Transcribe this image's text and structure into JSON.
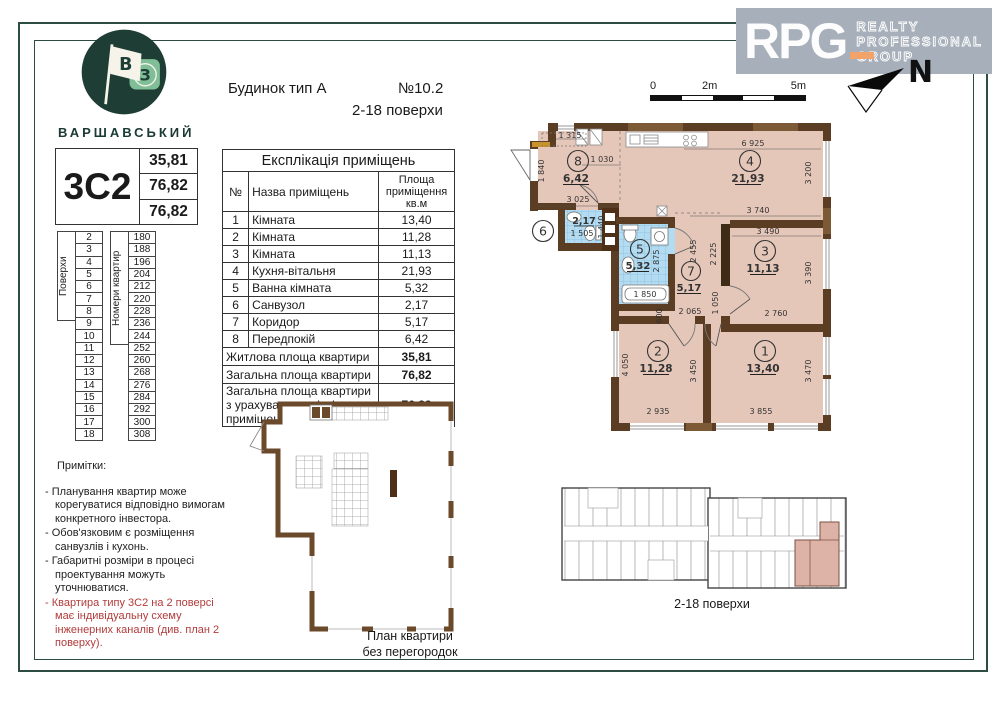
{
  "header": {
    "logo": {
      "brand": "ВАРШАВСЬКИЙ",
      "flag_letter_b": "В",
      "flag_letter_z": "З"
    },
    "building": "Будинок тип А",
    "plan_no": "№10.2",
    "floors_range": "2-18  поверхи",
    "rpg": {
      "acronym": "RPG",
      "lines": [
        "REALTY",
        "PROFESSIONAL",
        "GROUP"
      ],
      "north": "N"
    },
    "scalebar": {
      "l0": "0",
      "l2": "2m",
      "l5": "5m"
    }
  },
  "apartment": {
    "type": "3С2",
    "living_area": "35,81",
    "total_area": "76,82",
    "total_with_summer": "76,82"
  },
  "floors_table": {
    "col1_label": "Поверхи",
    "col2_label": "Номери квартир",
    "floors": [
      "2",
      "3",
      "4",
      "5",
      "6",
      "7",
      "8",
      "9",
      "10",
      "11",
      "12",
      "13",
      "14",
      "15",
      "16",
      "17",
      "18"
    ],
    "numbers": [
      "180",
      "188",
      "196",
      "204",
      "212",
      "220",
      "228",
      "236",
      "244",
      "252",
      "260",
      "268",
      "276",
      "284",
      "292",
      "300",
      "308"
    ]
  },
  "explication": {
    "title": "Експлікація приміщень",
    "col_no": "№",
    "col_name": "Назва приміщень",
    "col_area": "Площа приміщення кв.м",
    "rows": [
      {
        "no": "1",
        "name": "Кімната",
        "area": "13,40"
      },
      {
        "no": "2",
        "name": "Кімната",
        "area": "11,28"
      },
      {
        "no": "3",
        "name": "Кімната",
        "area": "11,13"
      },
      {
        "no": "4",
        "name": "Кухня-вітальня",
        "area": "21,93"
      },
      {
        "no": "5",
        "name": "Ванна кімната",
        "area": "5,32"
      },
      {
        "no": "6",
        "name": "Санвузол",
        "area": "2,17"
      },
      {
        "no": "7",
        "name": "Коридор",
        "area": "5,17"
      },
      {
        "no": "8",
        "name": "Передпокій",
        "area": "6,42"
      }
    ],
    "summary": [
      {
        "name": "Житлова площа квартири",
        "area": "35,81"
      },
      {
        "name": "Загальна площа квартири",
        "area": "76,82"
      },
      {
        "name": "Загальна площа квартири з урахуванням літніх приміщень",
        "area": "76,82"
      }
    ]
  },
  "notes": {
    "title": "Примітки:",
    "items": [
      "- Планування квартир може корегуватися відповідно вимогам конкретного інвестора.",
      "- Обов'язковим є розміщення санвузлів і кухонь.",
      "- Габаритні розміри в процесі проектування можуть уточнюватися.",
      "- Квартира типу 3С2 на 2 поверсі має індивідуальну схему інженерних каналів (див. план 2 поверху)."
    ]
  },
  "plan": {
    "rooms": [
      {
        "n": "1",
        "area": "13,40"
      },
      {
        "n": "2",
        "area": "11,28"
      },
      {
        "n": "3",
        "area": "11,13"
      },
      {
        "n": "4",
        "area": "21,93"
      },
      {
        "n": "5",
        "area": "5,32"
      },
      {
        "n": "6",
        "area": "2,17"
      },
      {
        "n": "7",
        "area": "5,17"
      },
      {
        "n": "8",
        "area": "6,42"
      }
    ],
    "dims": [
      "1 315",
      "1 030",
      "3 025",
      "1 840",
      "6 925",
      "3 200",
      "3 740",
      "3 490",
      "3 390",
      "2 760",
      "2 455",
      "2 225",
      "1 050",
      "2 065",
      "600",
      "2 875",
      "1 850",
      "1 505",
      "1 440",
      "4 050",
      "3 450",
      "2 935",
      "3 470",
      "3 855"
    ]
  },
  "captions": {
    "no_partitions_1": "План квартири",
    "no_partitions_2": "без перегородок",
    "overview": "2-18 поверхи"
  }
}
